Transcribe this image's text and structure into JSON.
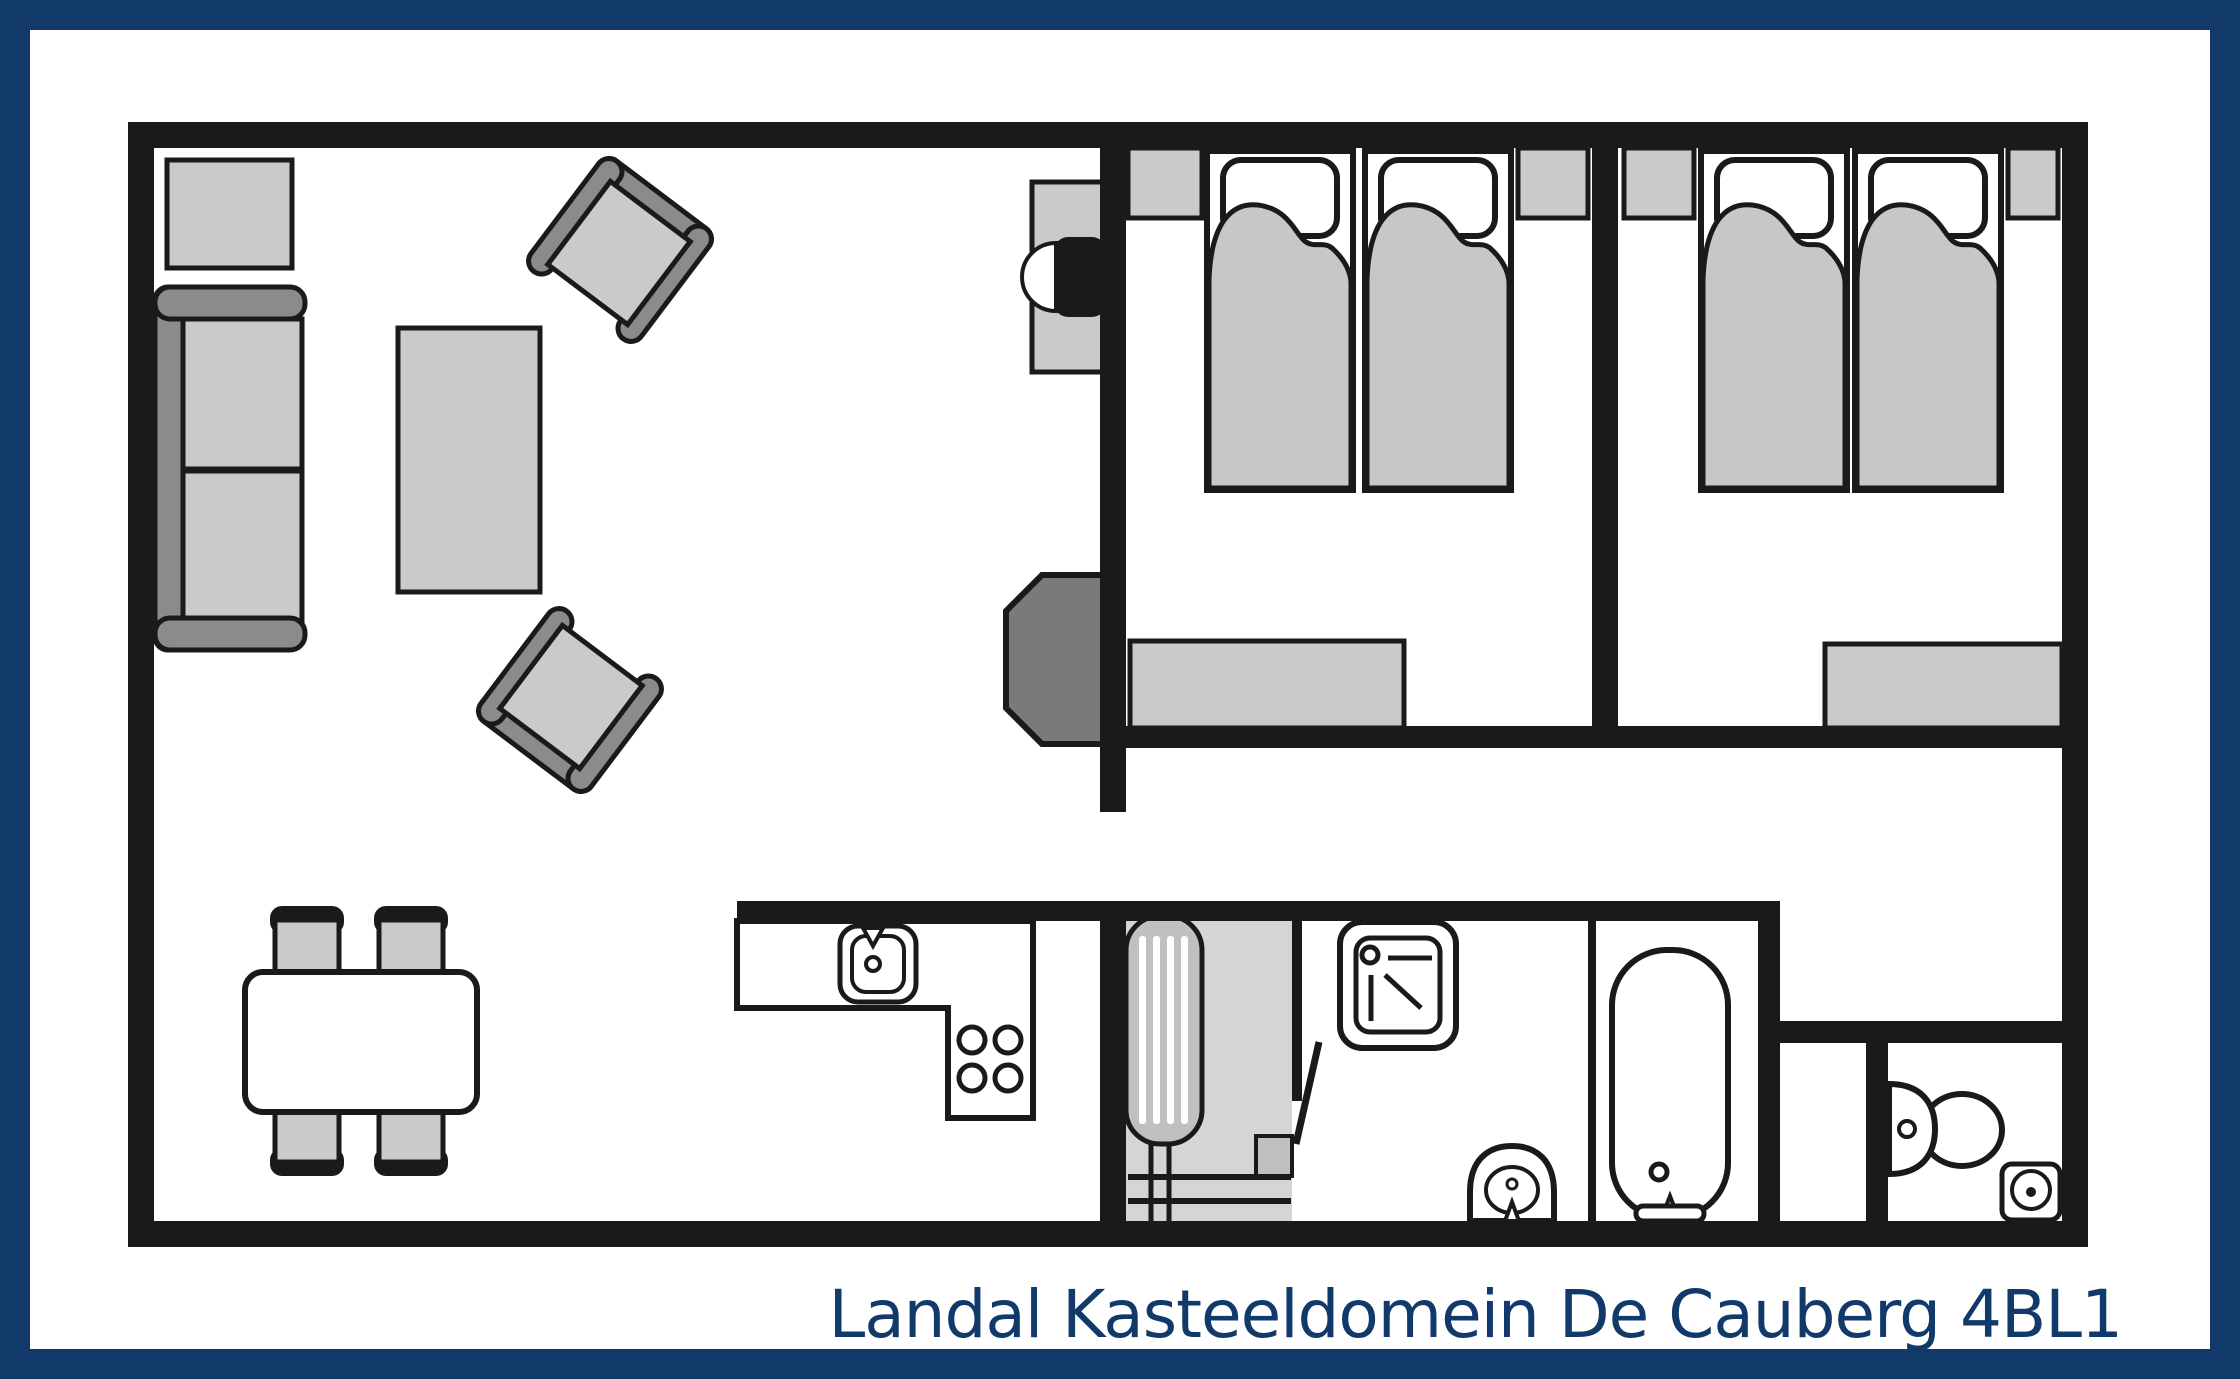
{
  "title": {
    "text": "Landal Kasteeldomein De Cauberg 4BL1"
  },
  "colors": {
    "navy": "#113a6b",
    "ink": "#1a1a1a",
    "light": "#c9cacb",
    "mid": "#c6c7c8",
    "dark": "#8a8b8d",
    "dark2": "#797a7c",
    "floor": "#d4d5d6",
    "boiler": "#bfc0c2"
  },
  "plan": {
    "type": "floor-plan",
    "unit_label": "4BL1",
    "rooms": [
      "living-room",
      "kitchen",
      "entrance-hall",
      "bedroom-1",
      "bedroom-2",
      "bathroom",
      "toilet-room",
      "duct-closet",
      "corridor"
    ],
    "furniture_icons": [
      "sideboard-icon",
      "sofa-icon",
      "armchair-icon",
      "coffee-table-icon",
      "dining-table-icon",
      "dining-chair-icon",
      "tv-cabinet-icon",
      "tv-icon",
      "wood-stove-icon",
      "kitchen-counter-icon",
      "sink-icon",
      "stove-burners-icon",
      "boiler-icon",
      "doormat-icon",
      "shower-icon",
      "washbasin-icon",
      "bathtub-icon",
      "toilet-icon",
      "corner-basin-icon",
      "bed-icon",
      "pillow-icon",
      "duvet-icon",
      "nightstand-icon",
      "bench-icon",
      "door-leaf-icon"
    ]
  }
}
